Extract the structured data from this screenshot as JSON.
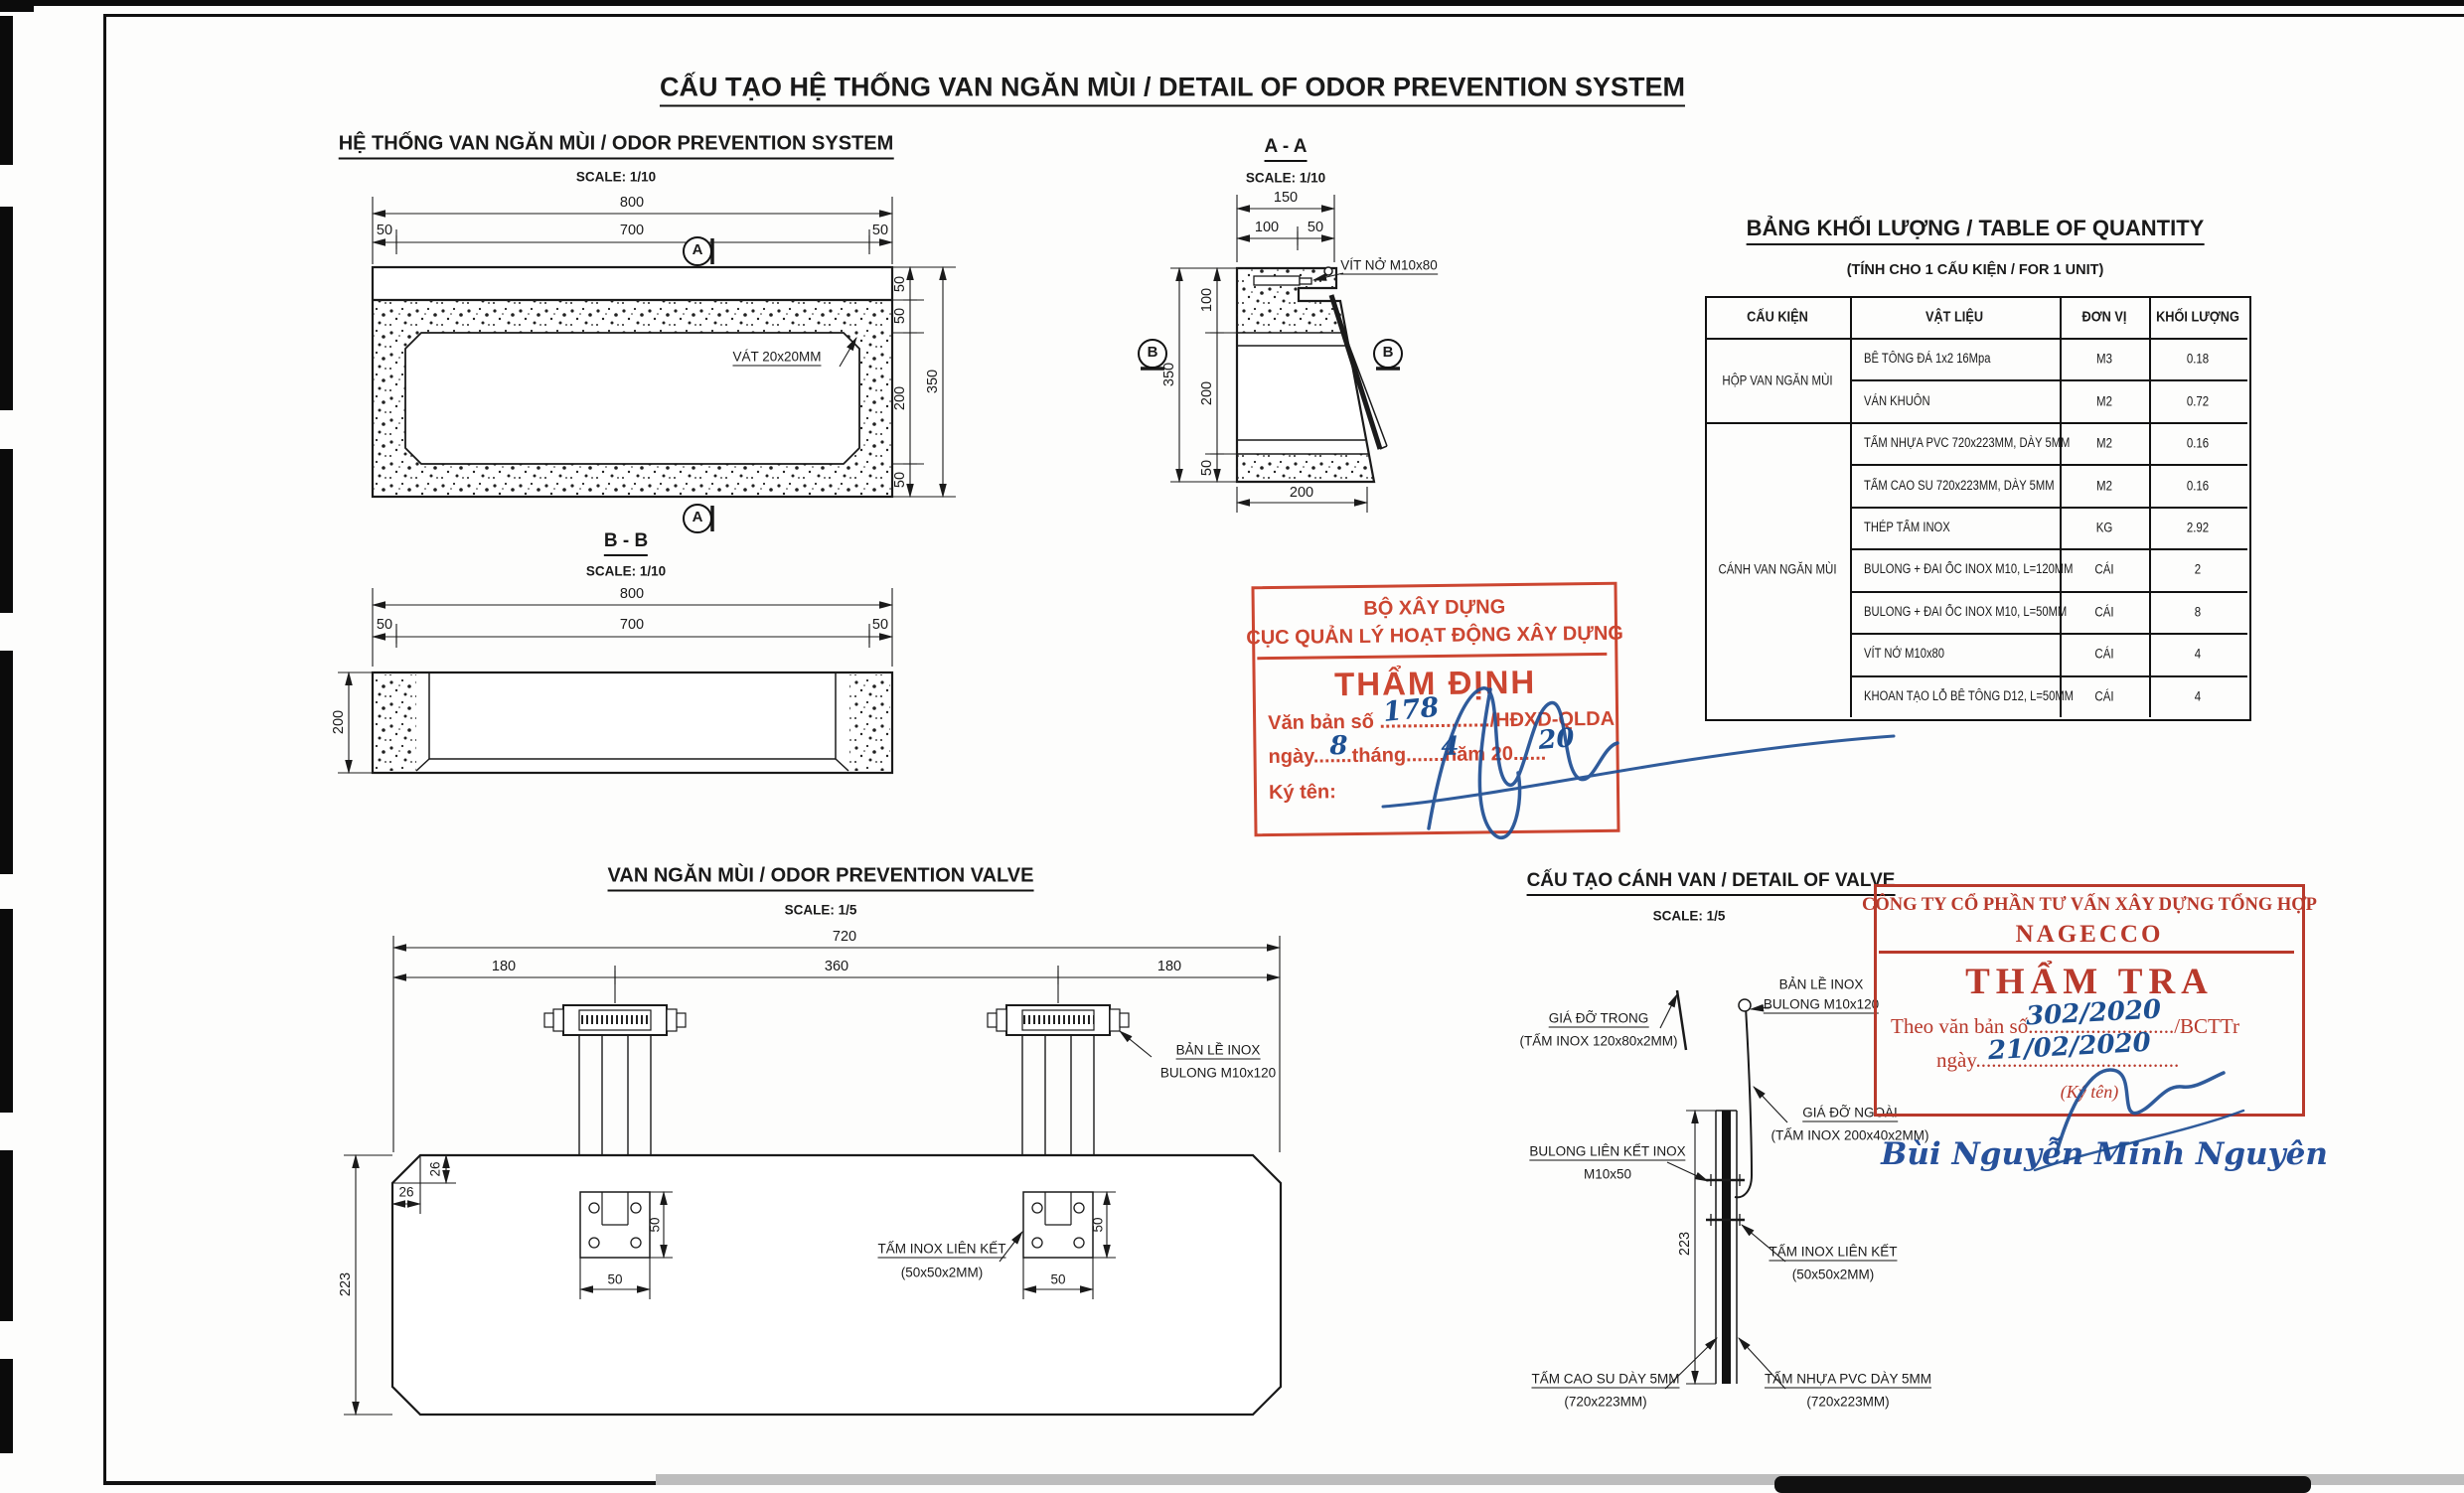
{
  "page": {
    "title": "CẤU TẠO HỆ THỐNG VAN NGĂN MÙI / DETAIL OF ODOR PREVENTION SYSTEM"
  },
  "views": {
    "system": {
      "title": "HỆ THỐNG VAN NGĂN MÙI / ODOR PREVENTION SYSTEM",
      "scale": "SCALE: 1/10",
      "marker": "A",
      "chamfer_label": "VÁT 20x20MM",
      "dims": {
        "w_total": "800",
        "w_left": "50",
        "w_mid": "700",
        "w_right": "50",
        "h1": "50",
        "h2": "50",
        "h3": "200",
        "h4": "50",
        "h_total": "350"
      }
    },
    "section_aa": {
      "title": "A - A",
      "scale": "SCALE: 1/10",
      "marker": "B",
      "bolt_label": "VÍT NỞ M10x80",
      "dims": {
        "top_total": "150",
        "top1": "100",
        "top2": "50",
        "l1": "100",
        "l2": "200",
        "l3": "50",
        "h_total": "350",
        "bottom": "200"
      }
    },
    "section_bb": {
      "title": "B - B",
      "scale": "SCALE: 1/10",
      "dims": {
        "w_total": "800",
        "w_left": "50",
        "w_mid": "700",
        "w_right": "50",
        "h": "200"
      }
    },
    "plan": {
      "title": "VAN NGĂN MÙI / ODOR PREVENTION VALVE",
      "scale": "SCALE: 1/5",
      "dims": {
        "w_total": "720",
        "w1": "180",
        "w2": "360",
        "w3": "180",
        "c_v": "26",
        "c_h": "26",
        "pw": "50",
        "ph": "50",
        "h": "223"
      },
      "labels": {
        "hinge1": "BẢN LỀ INOX",
        "hinge2": "BULONG M10x120",
        "plate1": "TẤM INOX LIÊN KẾT",
        "plate2": "(50x50x2MM)"
      }
    },
    "detail": {
      "title": "CẤU TẠO CÁNH VAN / DETAIL OF VALVE",
      "scale": "SCALE: 1/5",
      "dims": {
        "h": "223"
      },
      "labels": {
        "hinge1": "BẢN LỀ INOX",
        "hinge2": "BULONG M10x120",
        "inner1": "GIÁ ĐỠ TRONG",
        "inner2": "(TẤM INOX 120x80x2MM)",
        "outer1": "GIÁ ĐỠ NGOÀI",
        "outer2": "(TẤM INOX 200x40x2MM)",
        "bolt1": "BULONG LIÊN KẾT INOX",
        "bolt2": "M10x50",
        "plate1": "TẤM INOX LIÊN KẾT",
        "plate2": "(50x50x2MM)",
        "rubber1": "TẤM CAO SU DÀY 5MM",
        "rubber2": "(720x223MM)",
        "pvc1": "TẤM NHỰA PVC DÀY 5MM",
        "pvc2": "(720x223MM)"
      }
    }
  },
  "table": {
    "title": "BẢNG KHỐI LƯỢNG / TABLE OF QUANTITY",
    "subtitle": "(TÍNH CHO 1 CẤU KIỆN / FOR 1 UNIT)",
    "headers": [
      "CẤU KIỆN",
      "VẬT LIỆU",
      "ĐƠN VỊ",
      "KHỐI LƯỢNG"
    ],
    "groups": [
      {
        "label": "HỘP VAN NGĂN MÙI"
      },
      {
        "label": "CÁNH VAN NGĂN MÙI"
      }
    ],
    "rows": [
      {
        "material": "BÊ TÔNG ĐÁ 1x2 16Mpa",
        "unit": "M3",
        "qty": "0.18"
      },
      {
        "material": "VÁN KHUÔN",
        "unit": "M2",
        "qty": "0.72"
      },
      {
        "material": "TẤM NHỰA PVC 720x223MM, DÀY 5MM",
        "unit": "M2",
        "qty": "0.16"
      },
      {
        "material": "TẤM CAO SU 720x223MM, DÀY 5MM",
        "unit": "M2",
        "qty": "0.16"
      },
      {
        "material": "THÉP TẤM INOX",
        "unit": "KG",
        "qty": "2.92"
      },
      {
        "material": "BULONG + ĐAI ỐC INOX M10, L=120MM",
        "unit": "CÁI",
        "qty": "2"
      },
      {
        "material": "BULONG + ĐAI ỐC INOX M10, L=50MM",
        "unit": "CÁI",
        "qty": "8"
      },
      {
        "material": "VÍT NỞ M10x80",
        "unit": "CÁI",
        "qty": "4"
      },
      {
        "material": "KHOAN TẠO LỖ BÊ TÔNG D12, L=50MM",
        "unit": "CÁI",
        "qty": "4"
      }
    ]
  },
  "stamps": {
    "ministry": {
      "org1": "BỘ XÂY DỰNG",
      "org2": "CỤC QUẢN LÝ HOẠT ĐỘNG XÂY DỰNG",
      "title": "THẨM ĐỊNH",
      "doc_line": "Văn bản số ..................../HĐXD-QLDA",
      "doc_number": "178",
      "date_line": "ngày.......tháng.......năm 20......",
      "day": "8",
      "month": "4",
      "year": "20",
      "sign_label": "Ký tên:"
    },
    "nagecco": {
      "company": "CÔNG TY CỔ PHẦN TƯ VẤN XÂY DỰNG TỔNG HỢP",
      "name": "NAGECCO",
      "title": "THẨM TRA",
      "doc_line": "Theo văn bản số............................/BCTTr",
      "doc_number": "302/2020",
      "date_line": "ngày.......................................",
      "date_value": "21/02/2020",
      "sign_label": "(Ký tên)",
      "signer": "Bùi Nguyễn Minh Nguyên"
    }
  },
  "colors": {
    "stamp_red": "#cc4631",
    "hand_blue": "#1d4f91",
    "ink": "#1a1a1a"
  }
}
